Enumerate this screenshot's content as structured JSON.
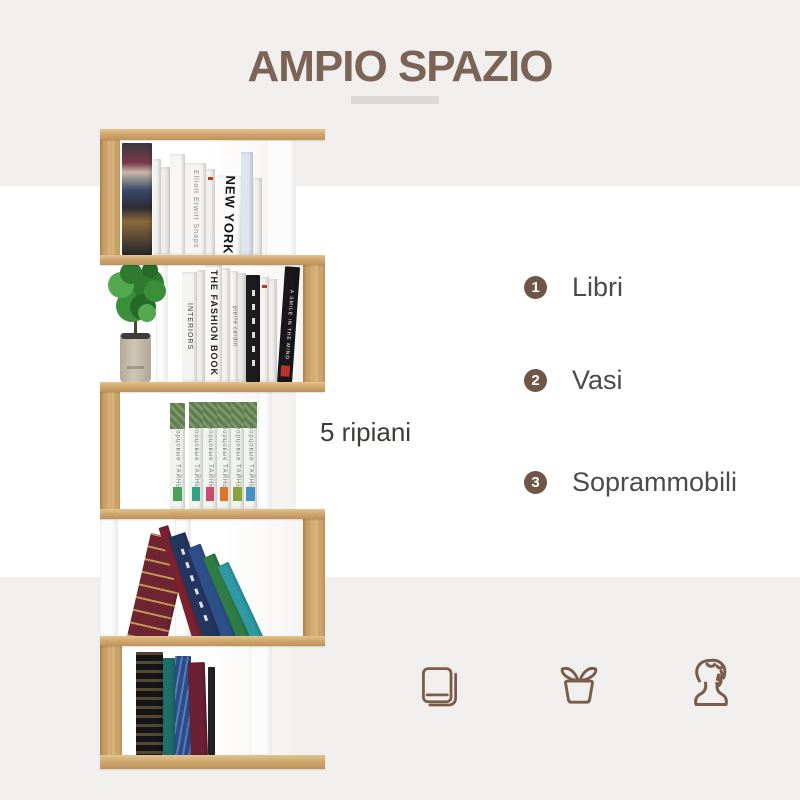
{
  "header": {
    "title": "AMPIO SPAZIO"
  },
  "colors": {
    "accent_brown": "#7b6355",
    "band_gray": "#f0efed",
    "underline_gray": "#d9d9d9",
    "feature_circle_brown": "#6f5646",
    "feature_label_gray": "#4b4b4b",
    "icon_brown": "#7a5b49",
    "oak_wood": "#cda26a",
    "white_panel": "#fcfcfc"
  },
  "shelf_caption": {
    "text": "5 ripiani"
  },
  "features": [
    {
      "number": "1",
      "label": "Libri"
    },
    {
      "number": "2",
      "label": "Vasi"
    },
    {
      "number": "3",
      "label": "Soprammobili"
    }
  ],
  "bottom_icons": [
    "book",
    "potted-plant",
    "bust-statue"
  ],
  "bookshelf": {
    "shelves_count": 5,
    "visible_spine_titles": [
      "Elliott Erwitt Snaps",
      "NEW YORK",
      "INTERIORS",
      "THE FASHION BOOK",
      "pierre cardin",
      "A SMILE IN THE MIND",
      "Дворцовые ТАЙНЫ"
    ],
    "plant": {
      "pot_color": "#c6bdae",
      "foliage_colors": [
        "#3c8f3a",
        "#2f7a30",
        "#54a84f",
        "#246b28"
      ]
    },
    "books": [
      {
        "x": 122,
        "y": 143,
        "w": 30,
        "h": 112,
        "bg": "#2b2b30",
        "deco": "art"
      },
      {
        "x": 153,
        "y": 159,
        "w": 8,
        "h": 96,
        "bg": "#f4f3f1"
      },
      {
        "x": 161,
        "y": 167,
        "w": 9,
        "h": 88,
        "bg": "#eeedeb"
      },
      {
        "x": 170,
        "y": 154,
        "w": 15,
        "h": 101,
        "bg": "#f7f6f4"
      },
      {
        "x": 185,
        "y": 163,
        "w": 21,
        "h": 92,
        "bg": "#f6f5f3",
        "txt": "Elliott Erwitt Snaps",
        "tc": "#8a8a8a",
        "fs": 7
      },
      {
        "x": 206,
        "y": 169,
        "w": 9,
        "h": 86,
        "bg": "#f2f1ef",
        "deco": "redline"
      },
      {
        "x": 215,
        "y": 175,
        "w": 26,
        "h": 80,
        "bg": "#fbfbfa",
        "rot": 2,
        "txt": "NEW YORK",
        "tc": "#141414",
        "fs": 13,
        "fw": "bold"
      },
      {
        "x": 241,
        "y": 152,
        "w": 12,
        "h": 103,
        "bg": "#dde6ee"
      },
      {
        "x": 253,
        "y": 178,
        "w": 9,
        "h": 77,
        "bg": "#f1f0ee"
      },
      {
        "x": 182,
        "y": 272,
        "w": 15,
        "h": 110,
        "bg": "#f5f4f2",
        "txt": "INTERIORS",
        "tc": "#333333",
        "fs": 7
      },
      {
        "x": 197,
        "y": 270,
        "w": 8,
        "h": 112,
        "bg": "#efeeea"
      },
      {
        "x": 205,
        "y": 265,
        "w": 17,
        "h": 117,
        "bg": "#f8f7f5",
        "txt": "THE FASHION BOOK",
        "tc": "#1e1e1e",
        "fs": 9,
        "fw": "bold"
      },
      {
        "x": 222,
        "y": 268,
        "w": 8,
        "h": 114,
        "bg": "#f3f2ef"
      },
      {
        "x": 230,
        "y": 271,
        "w": 8,
        "h": 111,
        "bg": "#f6f5f2",
        "txt": "pierre cardin",
        "tc": "#444444",
        "fs": 5
      },
      {
        "x": 238,
        "y": 273,
        "w": 8,
        "h": 109,
        "bg": "#eceae7"
      },
      {
        "x": 246,
        "y": 275,
        "w": 14,
        "h": 107,
        "bg": "#1c1c1f",
        "deco": "whitetext"
      },
      {
        "x": 260,
        "y": 277,
        "w": 9,
        "h": 105,
        "bg": "#f4f3f0",
        "deco": "redline"
      },
      {
        "x": 269,
        "y": 279,
        "w": 8,
        "h": 103,
        "bg": "#f0efec"
      },
      {
        "x": 277,
        "y": 266,
        "w": 15,
        "h": 116,
        "bg": "#181719",
        "rot": 4,
        "txt": "A SMILE IN THE MIND",
        "tc": "#ffffff",
        "fs": 5,
        "deco": "redbottom"
      },
      {
        "x": 170,
        "y": 403,
        "w": 15,
        "h": 106,
        "bg": "#f1f3ee",
        "deco": "ru",
        "lab": "#4aa05a",
        "txt": "Дворцовые ТАЙНЫ",
        "tc": "#777777",
        "fs": 6
      },
      {
        "x": 189,
        "y": 402,
        "w": 14,
        "h": 107,
        "bg": "#f1f3ee",
        "deco": "ru",
        "lab": "#35a08a",
        "txt": "Дворцовые ТАЙНЫ",
        "tc": "#777777",
        "fs": 6
      },
      {
        "x": 203,
        "y": 402,
        "w": 14,
        "h": 107,
        "bg": "#f1f3ee",
        "deco": "ru",
        "lab": "#c84b73",
        "txt": "Дворцовые ТАЙНЫ",
        "tc": "#777777",
        "fs": 6
      },
      {
        "x": 217,
        "y": 402,
        "w": 14,
        "h": 107,
        "bg": "#f1f3ee",
        "deco": "ru",
        "lab": "#e0732c",
        "txt": "Дворцовые ТАЙНЫ",
        "tc": "#777777",
        "fs": 6
      },
      {
        "x": 231,
        "y": 402,
        "w": 13,
        "h": 107,
        "bg": "#f1f3ee",
        "deco": "ru",
        "lab": "#8aa23c",
        "txt": "Дворцовые ТАЙНЫ",
        "tc": "#777777",
        "fs": 6
      },
      {
        "x": 244,
        "y": 402,
        "w": 13,
        "h": 107,
        "bg": "#f1f3ee",
        "deco": "ru",
        "lab": "#4a90c2",
        "txt": "Дворцовые ТАЙНЫ",
        "tc": "#777777",
        "fs": 6
      },
      {
        "x": 127,
        "y": 530,
        "w": 40,
        "h": 106,
        "bg": "#6e2531",
        "rot": 13,
        "deco": "goldlines"
      },
      {
        "x": 192,
        "y": 520,
        "w": 10,
        "h": 116,
        "bg": "#7a2230",
        "rot": -17
      },
      {
        "x": 203,
        "y": 526,
        "w": 18,
        "h": 110,
        "bg": "#24365f",
        "rot": -19,
        "deco": "whitetext"
      },
      {
        "x": 222,
        "y": 537,
        "w": 14,
        "h": 99,
        "bg": "#2d4f8a",
        "rot": -21
      },
      {
        "x": 237,
        "y": 546,
        "w": 13,
        "h": 90,
        "bg": "#2e7d46",
        "rot": -23
      },
      {
        "x": 251,
        "y": 554,
        "w": 12,
        "h": 82,
        "bg": "#2f9aa4",
        "rot": -25
      },
      {
        "x": 136,
        "y": 652,
        "w": 27,
        "h": 103,
        "bg": "#141419",
        "deco": "goldpattern"
      },
      {
        "x": 163,
        "y": 658,
        "w": 12,
        "h": 97,
        "bg": "#1e6f6a"
      },
      {
        "x": 175,
        "y": 656,
        "w": 16,
        "h": 99,
        "bg": "#2a4d8f",
        "deco": "scribble"
      },
      {
        "x": 191,
        "y": 662,
        "w": 17,
        "h": 93,
        "bg": "#6b2034",
        "rot": -2
      },
      {
        "x": 208,
        "y": 667,
        "w": 7,
        "h": 88,
        "bg": "#23232a"
      }
    ]
  }
}
